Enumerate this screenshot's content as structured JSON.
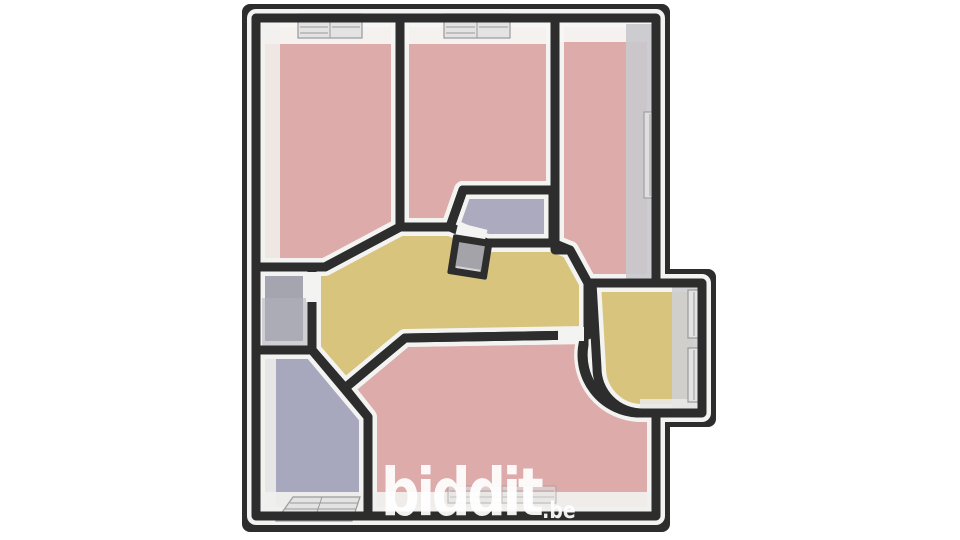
{
  "watermark": {
    "brand": "biddit",
    "tld": ".be"
  },
  "floorplan": {
    "theme": {
      "wall": "#2d2d2d",
      "bevel": "#f3f3f1",
      "window-fill": "#e3e3e3",
      "window-line": "#9a9a9a",
      "face-gray": "#c9c9cd",
      "band-white": "#f2f2f0"
    },
    "rooms": [
      {
        "name": "bedroom-top-left",
        "floor_color": "#dcabaa"
      },
      {
        "name": "bedroom-top-middle",
        "floor_color": "#dcabaa"
      },
      {
        "name": "bedroom-right",
        "floor_color": "#dcabaa"
      },
      {
        "name": "closet-left",
        "floor_color": "#a5a5af"
      },
      {
        "name": "room-bottom-left",
        "floor_color": "#a7a7bd"
      },
      {
        "name": "living-room-bottom",
        "floor_color": "#dcabaa"
      },
      {
        "name": "hallway",
        "floor_color": "#d8c47d"
      },
      {
        "name": "wc-middle",
        "floor_color": "#abaabe"
      },
      {
        "name": "room-right-extension",
        "floor_color": "#d8c47d"
      },
      {
        "name": "chimney-duct",
        "floor_color": "#a3a3a9"
      }
    ]
  }
}
